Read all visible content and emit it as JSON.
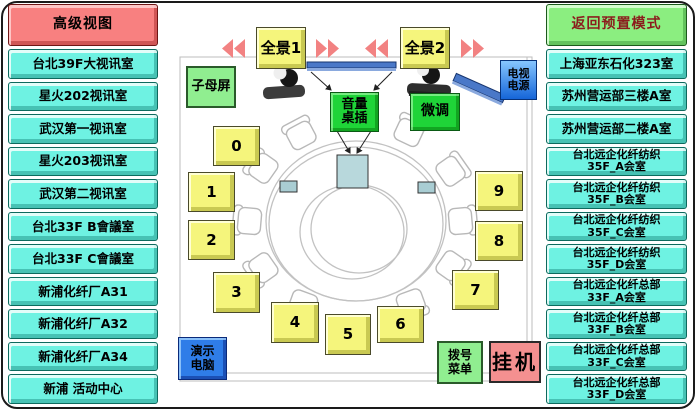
{
  "left_sidebar": {
    "view_button": {
      "label": "高级视图"
    },
    "rooms": [
      {
        "label": "台北39F大视讯室"
      },
      {
        "label": "星火202视讯室"
      },
      {
        "label": "武汉第一视讯室"
      },
      {
        "label": "星火203视讯室"
      },
      {
        "label": "武汉第二视讯室"
      },
      {
        "label": "台北33F B會議室"
      },
      {
        "label": "台北33F C會議室"
      },
      {
        "label": "新浦化纤厂A31"
      },
      {
        "label": "新浦化纤厂A32"
      },
      {
        "label": "新浦化纤厂A34"
      },
      {
        "label": "新浦 活动中心"
      }
    ]
  },
  "right_sidebar": {
    "mode_button": {
      "label": "返回预置模式"
    },
    "rooms": [
      {
        "label": "上海亚东石化323室"
      },
      {
        "label": "苏州营运部三楼A室"
      },
      {
        "label": "苏州营运部二楼A室"
      },
      {
        "label": "台北远企化纤纺织\n35F_A会室"
      },
      {
        "label": "台北远企化纤纺织\n35F_B会室"
      },
      {
        "label": "台北远企化纤纺织\n35F_C会室"
      },
      {
        "label": "台北远企化纤纺织\n35F_D会室"
      },
      {
        "label": "台北远企化纤总部\n33F_A会室"
      },
      {
        "label": "台北远企化纤总部\n33F_B会室"
      },
      {
        "label": "台北远企化纤总部\n33F_C会室"
      },
      {
        "label": "台北远企化纤总部\n33F_D会室"
      }
    ]
  },
  "room_view": {
    "panorama1_button": {
      "label": "全景1"
    },
    "panorama2_button": {
      "label": "全景2"
    },
    "pip_button": {
      "label": "子母屏"
    },
    "tv_power_button": {
      "label": "电视\n电源"
    },
    "volume_socket_button": {
      "label": "音量\n桌插"
    },
    "fine_tune_button": {
      "label": "微调"
    },
    "demo_pc_button": {
      "label": "演示\n电脑"
    },
    "dial_menu_button": {
      "label": "拨号\n菜单"
    },
    "hangup_button": {
      "label": "挂机"
    },
    "seat_presets": [
      {
        "label": "0"
      },
      {
        "label": "1"
      },
      {
        "label": "2"
      },
      {
        "label": "3"
      },
      {
        "label": "4"
      },
      {
        "label": "5"
      },
      {
        "label": "6"
      },
      {
        "label": "7"
      },
      {
        "label": "8"
      },
      {
        "label": "9"
      }
    ]
  },
  "colors": {
    "cyan_button": "#6ef2e2",
    "red_button": "#f88080",
    "green_button": "#8bee80",
    "yellow_button": "#f5f57c",
    "bright_green_button": "#1fd438",
    "blue_button": "#2f7de8",
    "salmon_button": "#f49090",
    "arrow": "#f28282",
    "tv_bar": "#4a78c8",
    "wall_line": "#bdbdbd"
  }
}
